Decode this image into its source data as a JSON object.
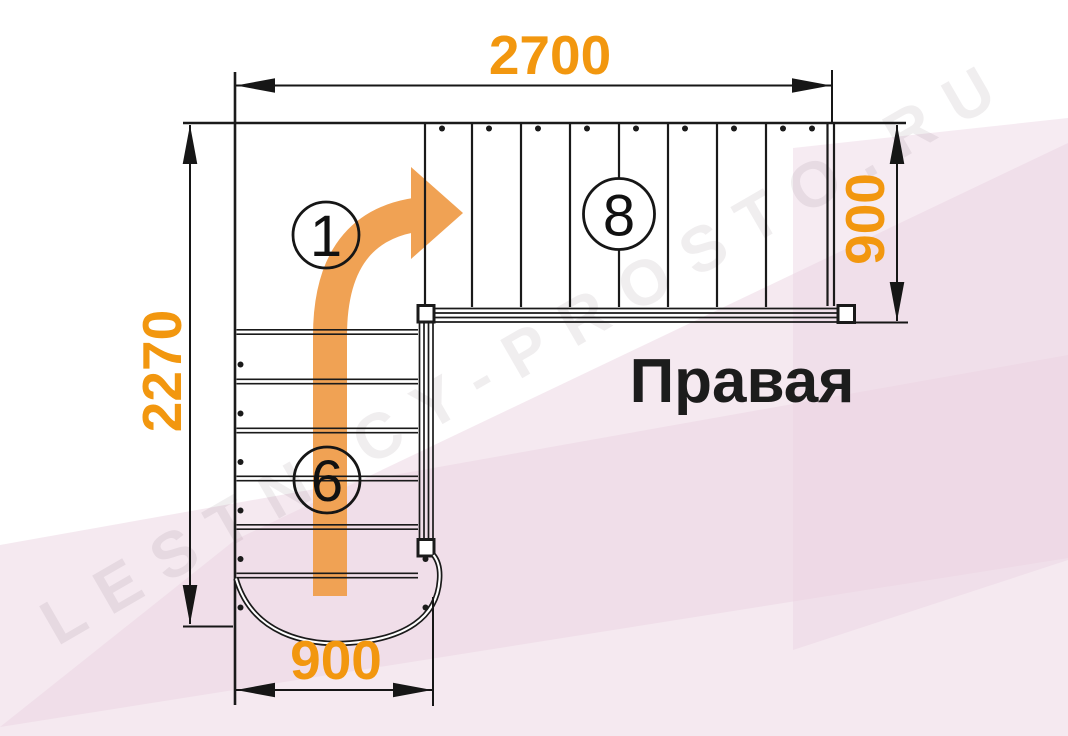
{
  "diagram": {
    "title": "Правая",
    "watermark": "LESTNICY-PROSTO.RU",
    "dimensions": {
      "top_width": "2700",
      "left_height": "2270",
      "right_depth": "900",
      "bottom_width": "900"
    },
    "markers": {
      "direction_start": "1",
      "upper_flight_steps": "8",
      "lower_flight_steps": "6"
    },
    "colors": {
      "dimension_text": "#F2970F",
      "route_arrow": "#F0A254",
      "linework": "#1A1A1A",
      "background_tint": "#F3E3EC"
    }
  }
}
